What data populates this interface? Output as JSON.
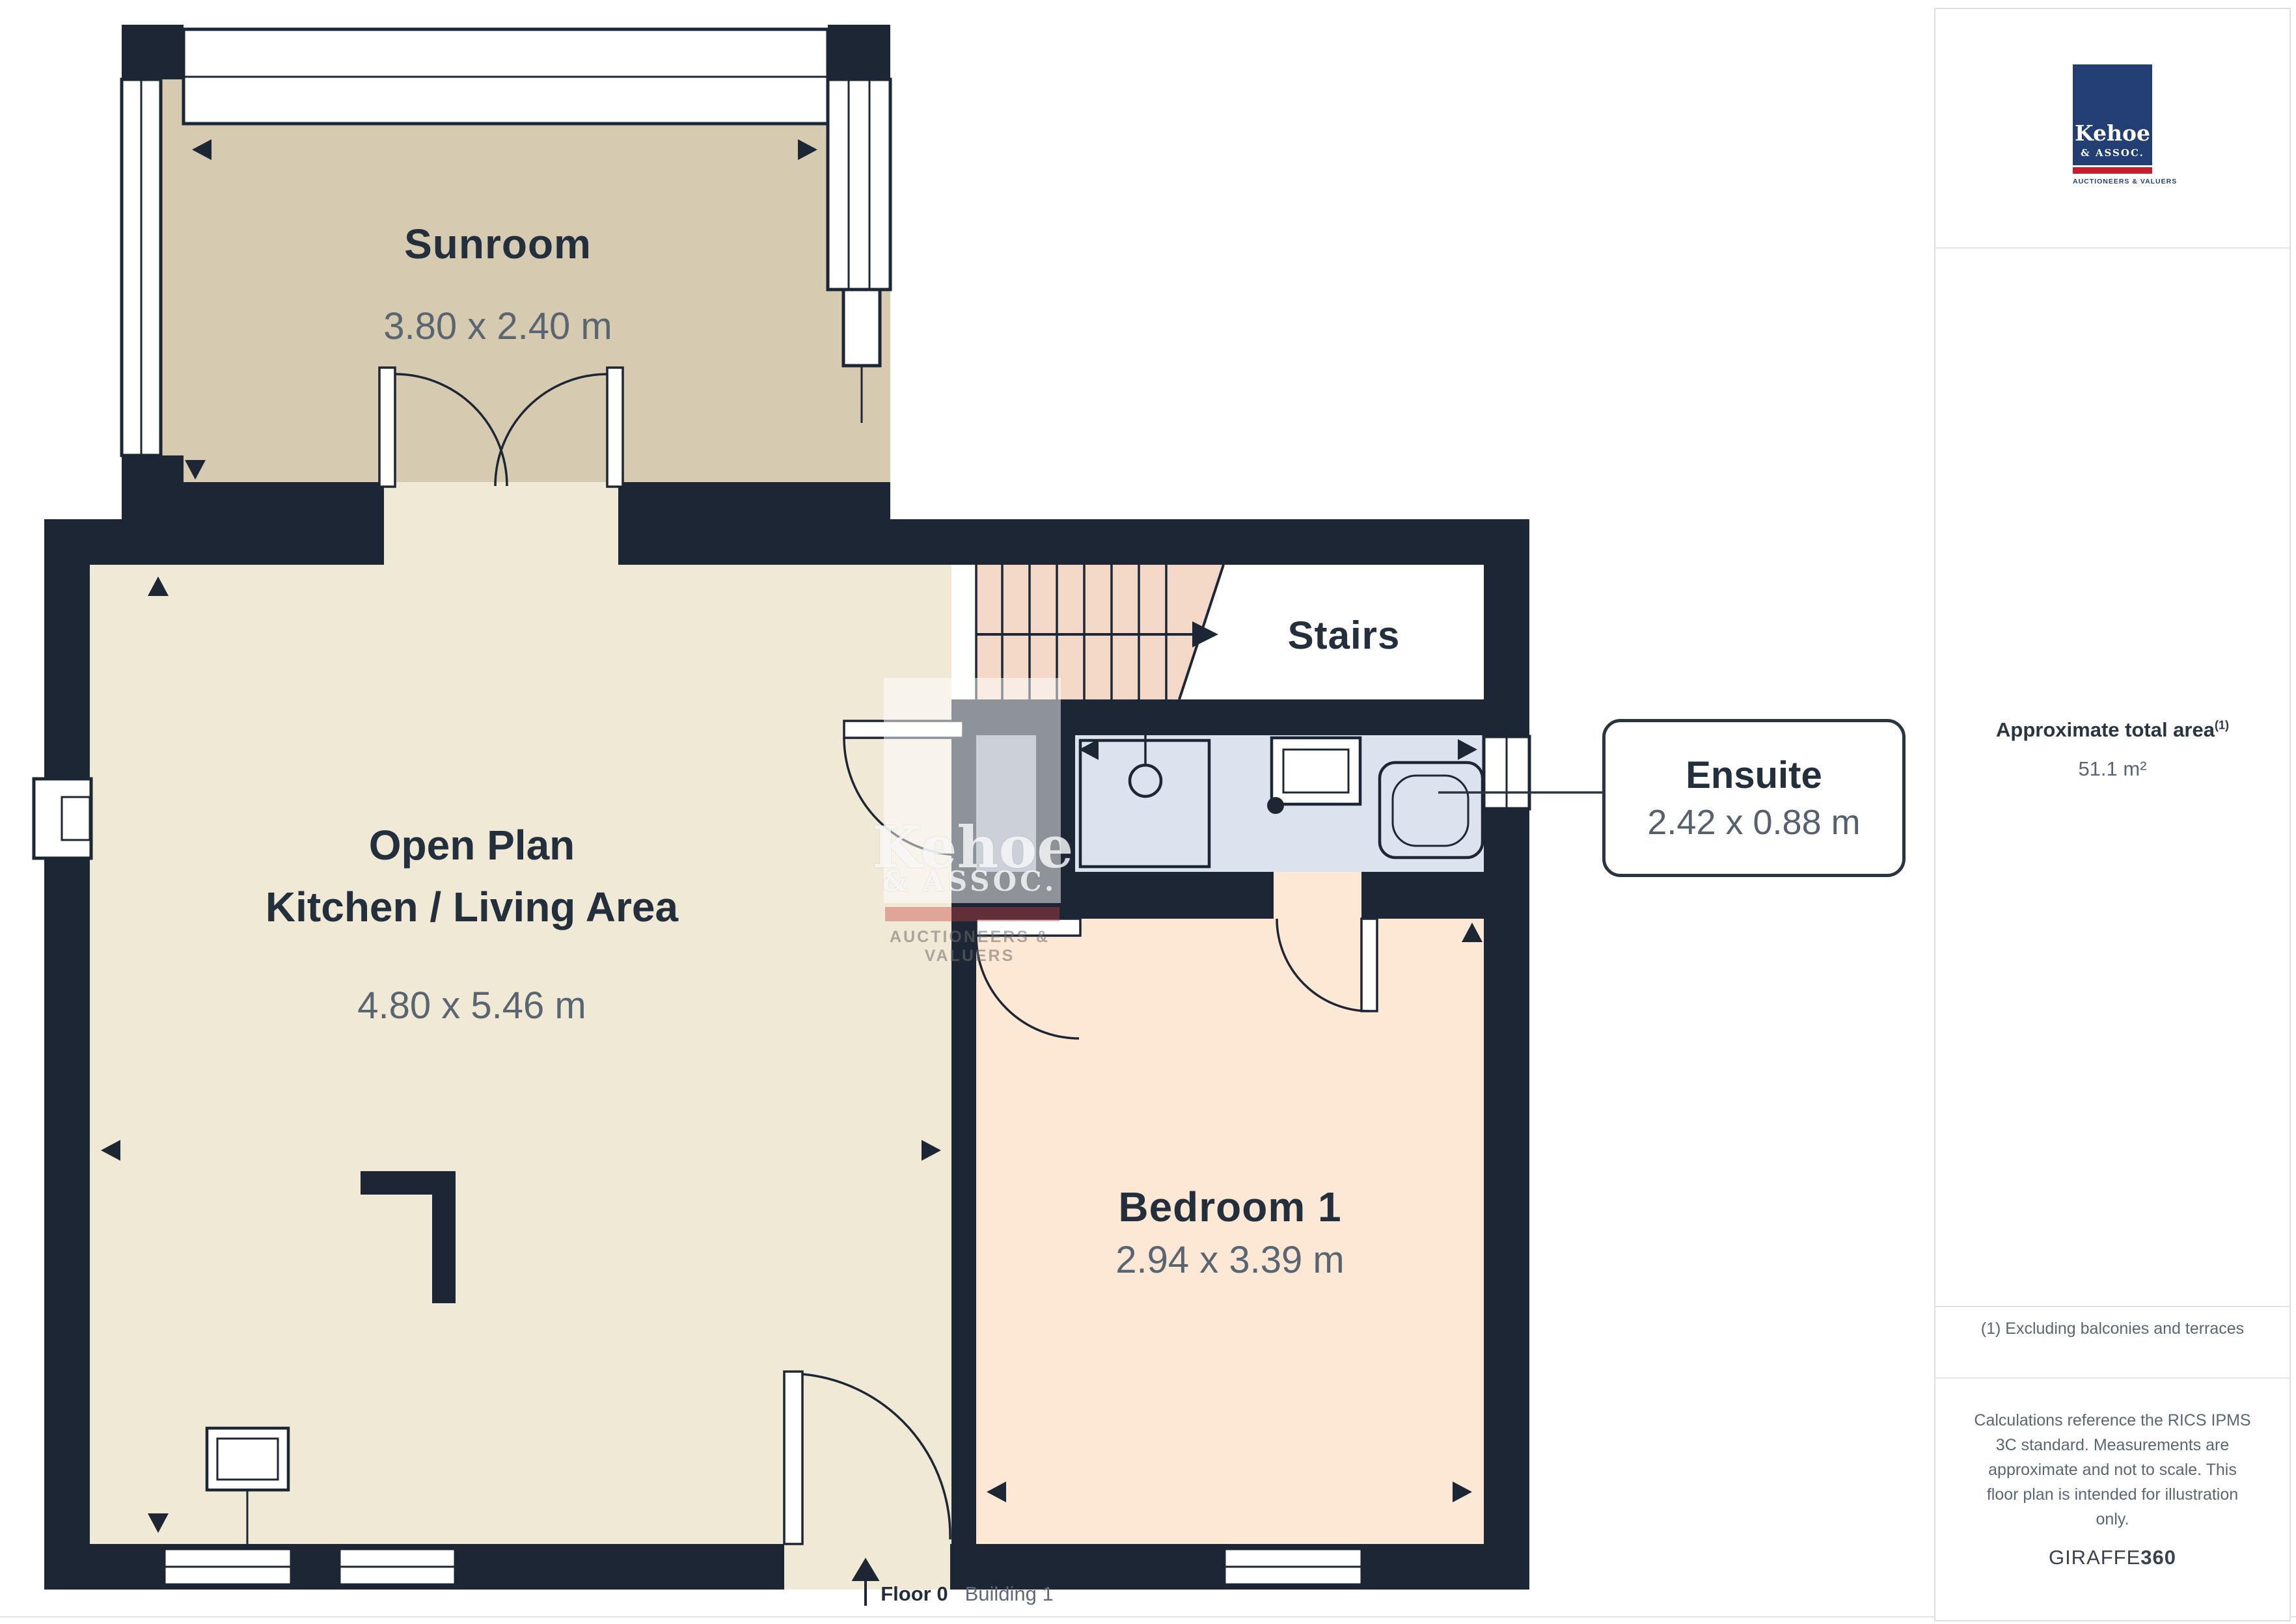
{
  "plan": {
    "rooms": {
      "sunroom": {
        "name": "Sunroom",
        "dims": "3.80 x 2.40 m"
      },
      "open_plan": {
        "name_line1": "Open Plan",
        "name_line2": "Kitchen / Living Area",
        "dims": "4.80 x 5.46 m"
      },
      "stairs": {
        "name": "Stairs"
      },
      "ensuite": {
        "name": "Ensuite",
        "dims": "2.42 x 0.88 m"
      },
      "bedroom": {
        "name": "Bedroom 1",
        "dims": "2.94 x 3.39 m"
      }
    },
    "floor_label": {
      "floor": "Floor 0",
      "building": "Building 1"
    }
  },
  "watermark": {
    "name": "Kehoe",
    "sub": "& ASSOC.",
    "tagline": "AUCTIONEERS & VALUERS"
  },
  "sidebar": {
    "logo": {
      "name": "Kehoe",
      "sub": "& ASSOC.",
      "tagline": "AUCTIONEERS & VALUERS"
    },
    "area": {
      "label": "Approximate total area",
      "footnote_ref": "(1)",
      "value": "51.1 m²"
    },
    "footnote": "(1) Excluding balconies and terraces",
    "disclaimer": "Calculations reference the RICS IPMS 3C standard. Measurements are approximate and not to scale. This floor plan is intended for illustration only.",
    "brand": {
      "giraffe": "GIRAFFE",
      "threesixty": "360"
    }
  },
  "colors": {
    "wall": "#1d2634",
    "sunroom_floor": "#d6cbb1",
    "open_plan_floor": "#f0e9d6",
    "bedroom_floor": "#fce8d5",
    "stairs_floor": "#f3d8c8",
    "ensuite_floor": "#dce2ee",
    "understairs_gray": "#97a0b2",
    "logo_navy": "#223e73",
    "logo_red": "#c3202e",
    "text_dark": "#232f3d",
    "text_dim": "#5a6675"
  }
}
